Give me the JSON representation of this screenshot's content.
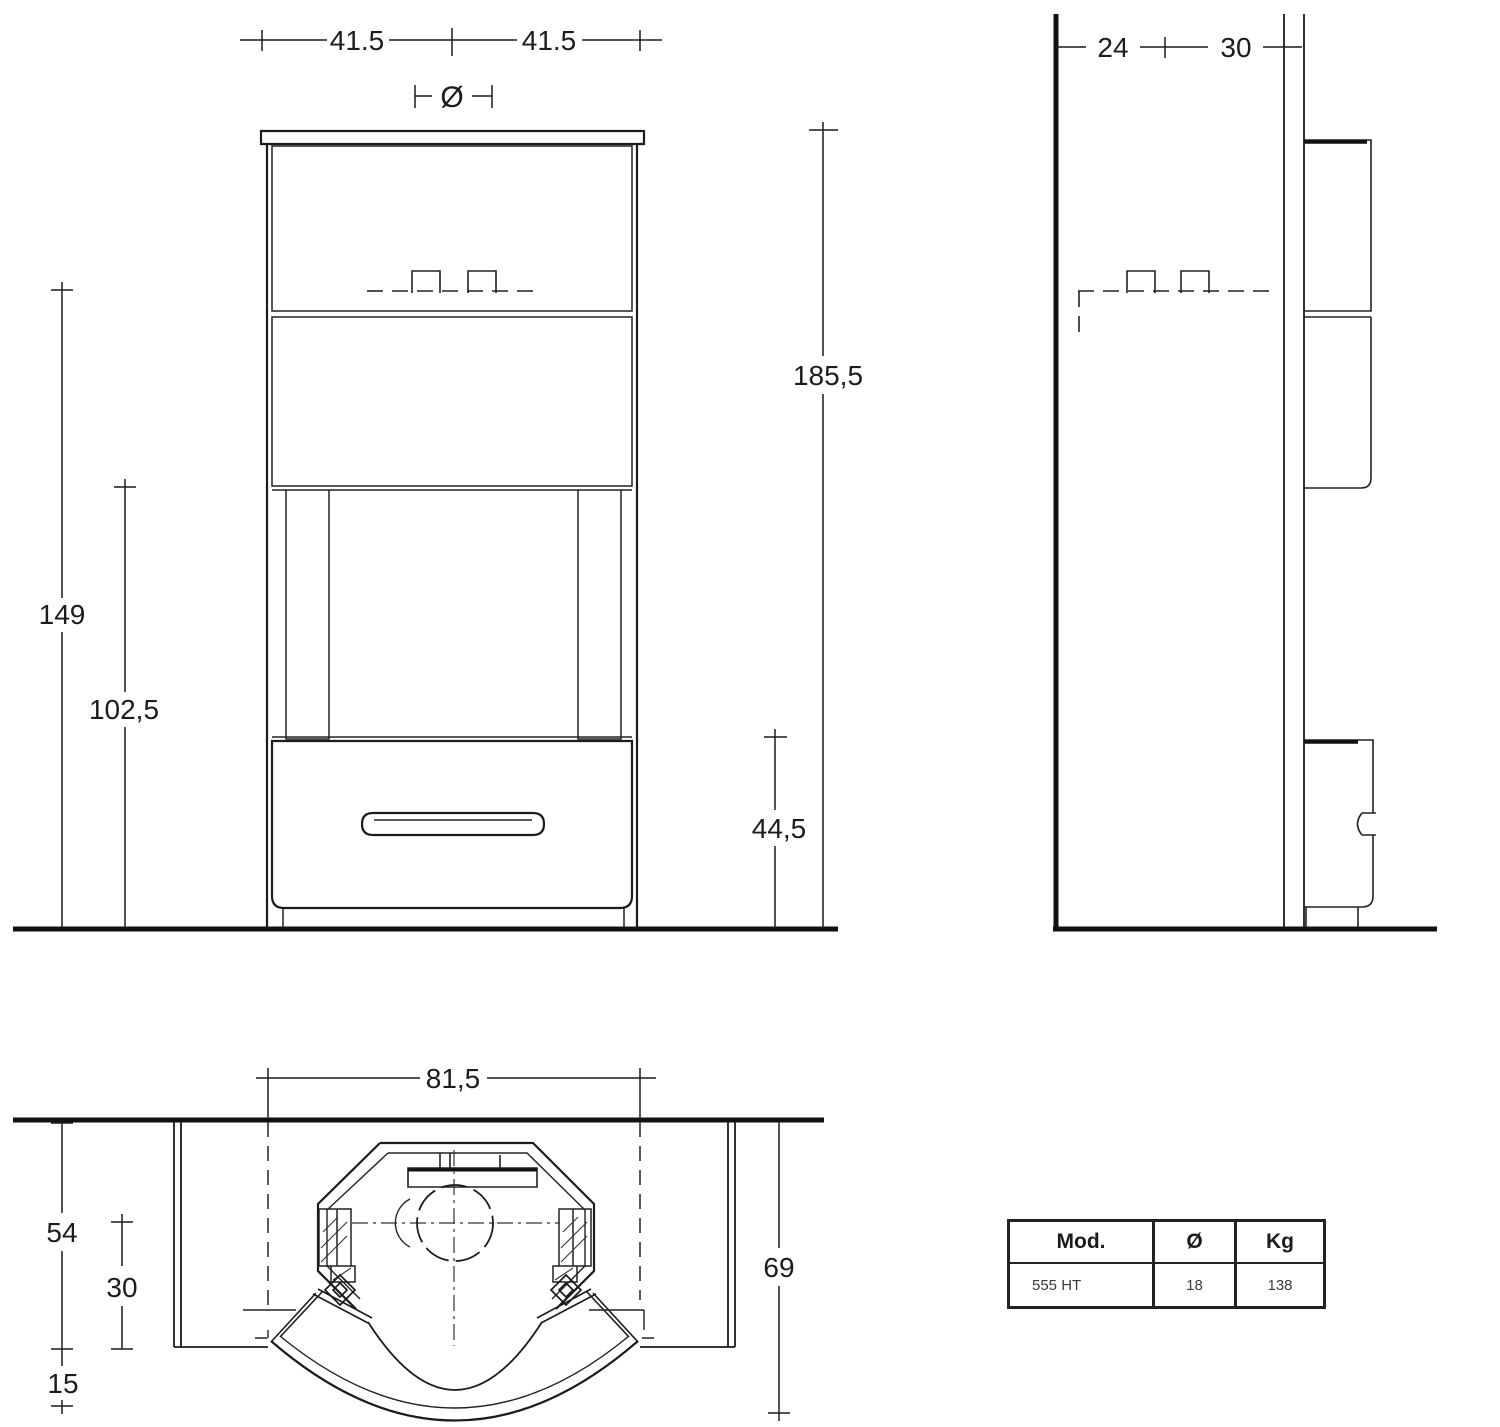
{
  "drawing": {
    "front": {
      "width_left": "41.5",
      "width_right": "41.5",
      "flue_symbol": "Ø",
      "height_total": "185,5",
      "height_register": "149",
      "height_opening": "102,5",
      "height_base": "44,5"
    },
    "side": {
      "depth_back": "24",
      "depth_front": "30"
    },
    "plan": {
      "opening_width": "81,5",
      "depth_body": "54",
      "flue_center_depth": "30",
      "door_depth": "15",
      "depth_total": "69"
    },
    "table": {
      "headers": [
        "Mod.",
        "Ø",
        "Kg"
      ],
      "row": [
        "555 HT",
        "18",
        "138"
      ]
    }
  }
}
